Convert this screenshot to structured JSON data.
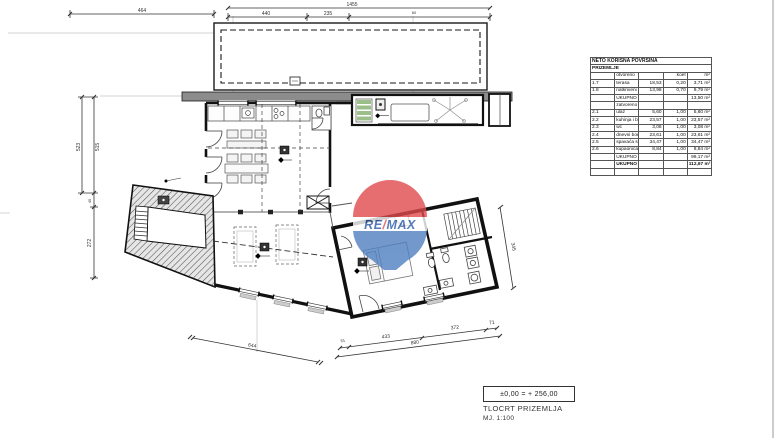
{
  "title_block": {
    "elevation": "±0,00 = + 256,00",
    "title": "TLOCRT PRIZEMLJA",
    "scale": "MJ. 1:100"
  },
  "watermark": {
    "re": "RE",
    "slash": "/",
    "max": "MAX"
  },
  "area_table": {
    "title": "NETO KORISNA POVRŠINA",
    "floor": "PRIZEMLJE",
    "rows": [
      {
        "kind": "sub",
        "no": "",
        "name": "otvoreno",
        "area": "",
        "coef": "koef",
        "total": "m²"
      },
      {
        "kind": "room",
        "no": "1.7",
        "name": "terasa",
        "area": "18,53",
        "coef": "0,20",
        "total": "3,71 m²"
      },
      {
        "kind": "room",
        "no": "1.8",
        "name": "natkriveni prostor",
        "area": "13,98",
        "coef": "0,70",
        "total": "9,79 m²"
      },
      {
        "kind": "sum",
        "no": "",
        "name": "UKUPNO otvoreni prostori",
        "area": "",
        "coef": "",
        "total": "13,50 m²"
      },
      {
        "kind": "sub",
        "no": "",
        "name": "zatvoreno",
        "area": "",
        "coef": "",
        "total": ""
      },
      {
        "kind": "room",
        "no": "2.1",
        "name": "ulaz",
        "area": "5,60",
        "coef": "1,00",
        "total": "5,60 m²"
      },
      {
        "kind": "room",
        "no": "2.2",
        "name": "kuhinja i blagovaonica",
        "area": "23,57",
        "coef": "1,00",
        "total": "23,57 m²"
      },
      {
        "kind": "room",
        "no": "2.3",
        "name": "wc",
        "area": "3,08",
        "coef": "1,00",
        "total": "3,08 m²"
      },
      {
        "kind": "room",
        "no": "2.4",
        "name": "dnevni boravak",
        "area": "23,61",
        "coef": "1,00",
        "total": "23,61 m²"
      },
      {
        "kind": "room",
        "no": "2.5",
        "name": "spavaća soba",
        "area": "34,47",
        "coef": "1,00",
        "total": "34,47 m²"
      },
      {
        "kind": "room",
        "no": "2.6",
        "name": "kupaonica",
        "area": "8,84",
        "coef": "1,00",
        "total": "8,84 m²"
      },
      {
        "kind": "sum",
        "no": "",
        "name": "UKUPNO zatvoreni prostori",
        "area": "",
        "coef": "",
        "total": "99,17 m²"
      },
      {
        "kind": "total",
        "no": "",
        "name": "UKUPNO - PRIZEMLJE",
        "area": "",
        "coef": "",
        "total": "112,67 m²"
      },
      {
        "kind": "empty",
        "no": "",
        "name": "",
        "area": "",
        "coef": "",
        "total": ""
      }
    ]
  },
  "dims": {
    "top_left": "464",
    "top_total": "1455",
    "top_seg1": "440",
    "top_seg2": "235",
    "top_seg3": "60",
    "left_out": "523",
    "left_in": "515",
    "left_mid": "45",
    "left_low": "272",
    "bottom_left": "644",
    "br_start": "51",
    "br_seg1": "433",
    "br_seg2": "372",
    "br_seg3": "71",
    "br_total": "880",
    "side_right": "345"
  },
  "colors": {
    "remax_red": "#e04a4e",
    "remax_blue": "#4f7fc0",
    "remax_text": "#2c5ba8"
  }
}
